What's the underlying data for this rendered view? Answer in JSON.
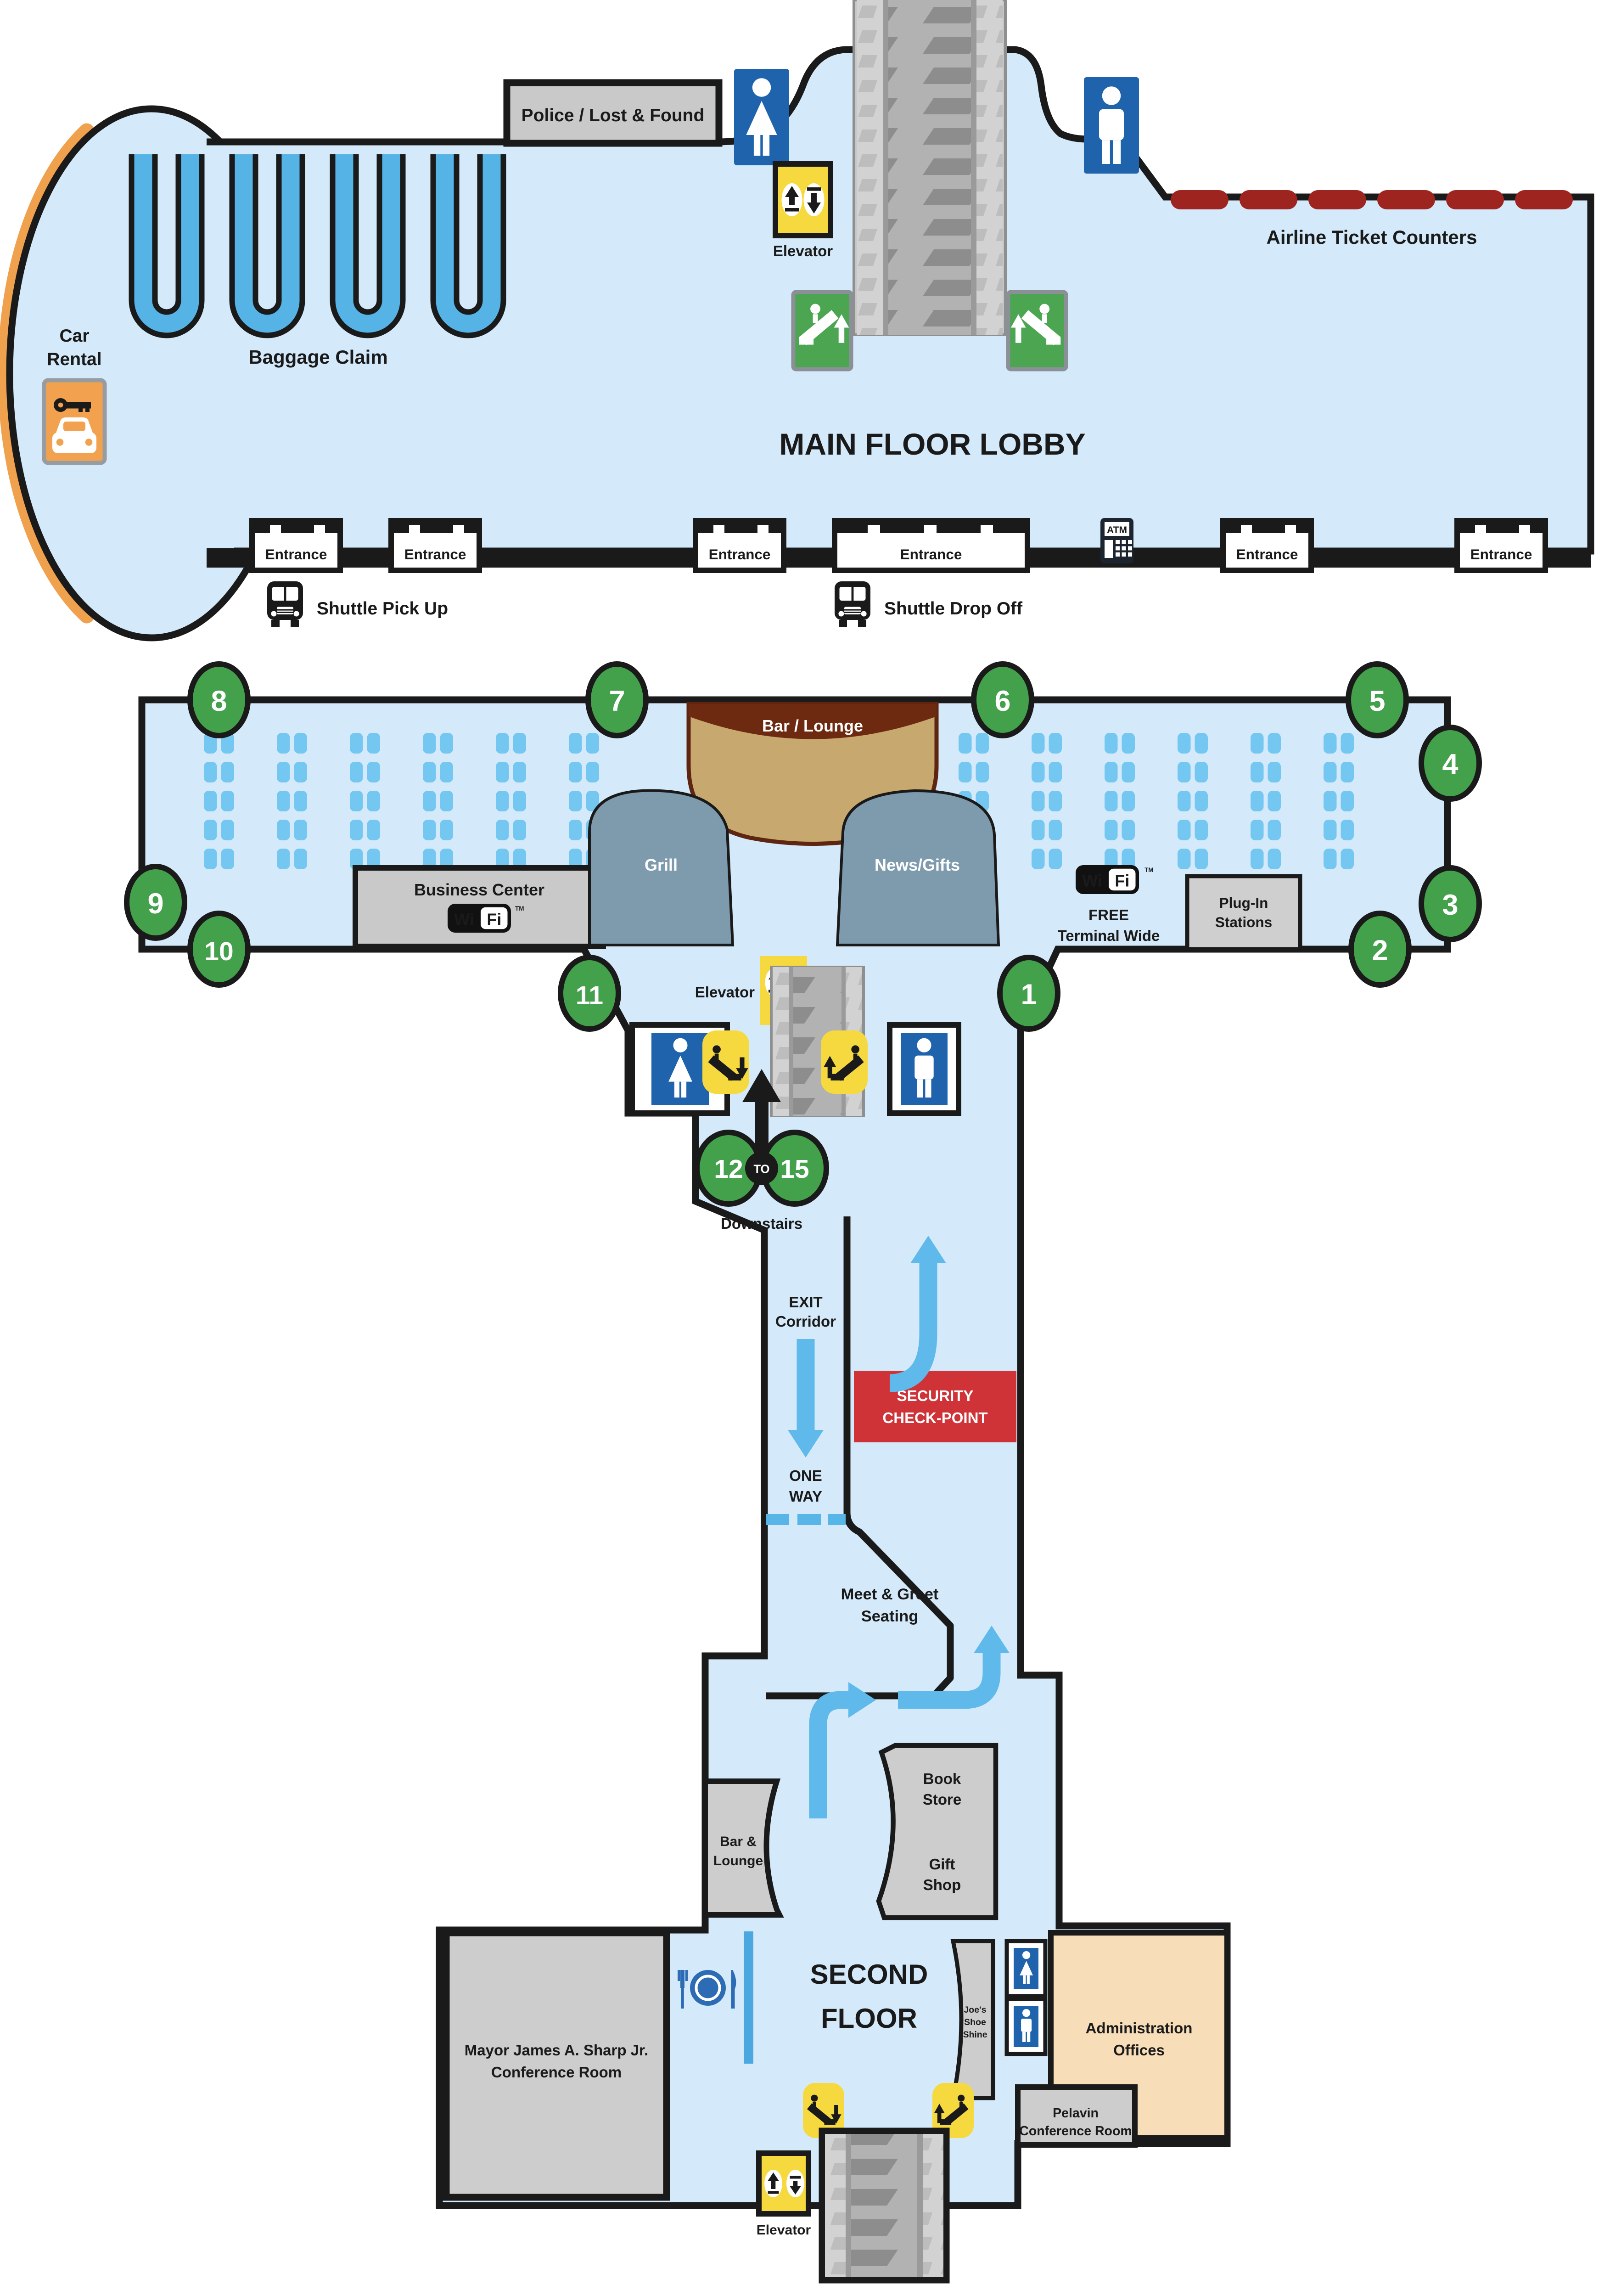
{
  "map_title": "Airport Terminal Floor Plan",
  "colors": {
    "wall": "#1a1a1a",
    "floor_blue": "#d4eafa",
    "seat_blue": "#74c7f0",
    "carousel_blue": "#55b3e6",
    "arrow_blue": "#5fb9ea",
    "partition_blue": "#4aa7e0",
    "restroom_blue": "#1f63ad",
    "dining_blue": "#2d6cb5",
    "gate_green": "#43a04b",
    "escalator_sign_green": "#4ba551",
    "elevator_yellow": "#f6d93e",
    "security_red": "#cf3338",
    "ticket_counter_red": "#9e2420",
    "road_orange": "#f0a14d",
    "car_rental_orange": "#f2a24e",
    "bar_lounge_tan": "#c7a96f",
    "bar_lounge_brown": "#6e2a10",
    "dome_slate": "#7e9bae",
    "box_gray": "#cdcdcd",
    "admin_peach": "#f8ddb9",
    "atm_navy": "#1c2430"
  },
  "main_floor": {
    "police": "Police / Lost & Found",
    "title": "MAIN FLOOR LOBBY",
    "airline": "Airline Ticket Counters",
    "baggage": "Baggage Claim",
    "car_rental": [
      "Car",
      "Rental"
    ],
    "entrance": "Entrance",
    "shuttle_pick_up": "Shuttle Pick Up",
    "shuttle_drop_off": "Shuttle Drop Off",
    "elevator": "Elevator",
    "atm": "ATM"
  },
  "concourse": {
    "bar_lounge": "Bar / Lounge",
    "plug_in": [
      "Plug-In",
      "Stations"
    ],
    "plug_in_box": [
      "Plug-In",
      "Stations"
    ],
    "business_center": "Business Center",
    "grill": "Grill",
    "news_gifts": "News/Gifts",
    "wifi": {
      "wi": "Wi",
      "fi": "Fi",
      "tm": "TM"
    },
    "free_wifi": [
      "FREE",
      "Terminal Wide"
    ],
    "elevator": "Elevator",
    "downstairs": "Downstairs",
    "gates": {
      "g1": "1",
      "g2": "2",
      "g3": "3",
      "g4": "4",
      "g5": "5",
      "g6": "6",
      "g7": "7",
      "g8": "8",
      "g9": "9",
      "g10": "10",
      "g11": "11",
      "g12": "12",
      "g15": "15",
      "to": "TO"
    }
  },
  "corridor": {
    "exit": [
      "EXIT",
      "Corridor"
    ],
    "one_way": [
      "ONE",
      "WAY"
    ],
    "security": [
      "SECURITY",
      "CHECK-POINT"
    ]
  },
  "second_floor": {
    "meet_greet": [
      "Meet & Greet",
      "Seating"
    ],
    "book_store": [
      "Book",
      "Store"
    ],
    "gift_shop": [
      "Gift",
      "Shop"
    ],
    "bar_lounge": [
      "Bar &",
      "Lounge"
    ],
    "title": [
      "SECOND",
      "FLOOR"
    ],
    "mayor": [
      "Mayor James A. Sharp Jr.",
      "Conference Room"
    ],
    "joes": [
      "Joe's",
      "Shoe",
      "Shine"
    ],
    "admin": [
      "Administration",
      "Offices"
    ],
    "pelavin": [
      "Pelavin",
      "Conference Room"
    ],
    "elevator": "Elevator"
  },
  "seating": {
    "rows": 5,
    "groups_per_side": 6,
    "seats_per_group": 2
  }
}
